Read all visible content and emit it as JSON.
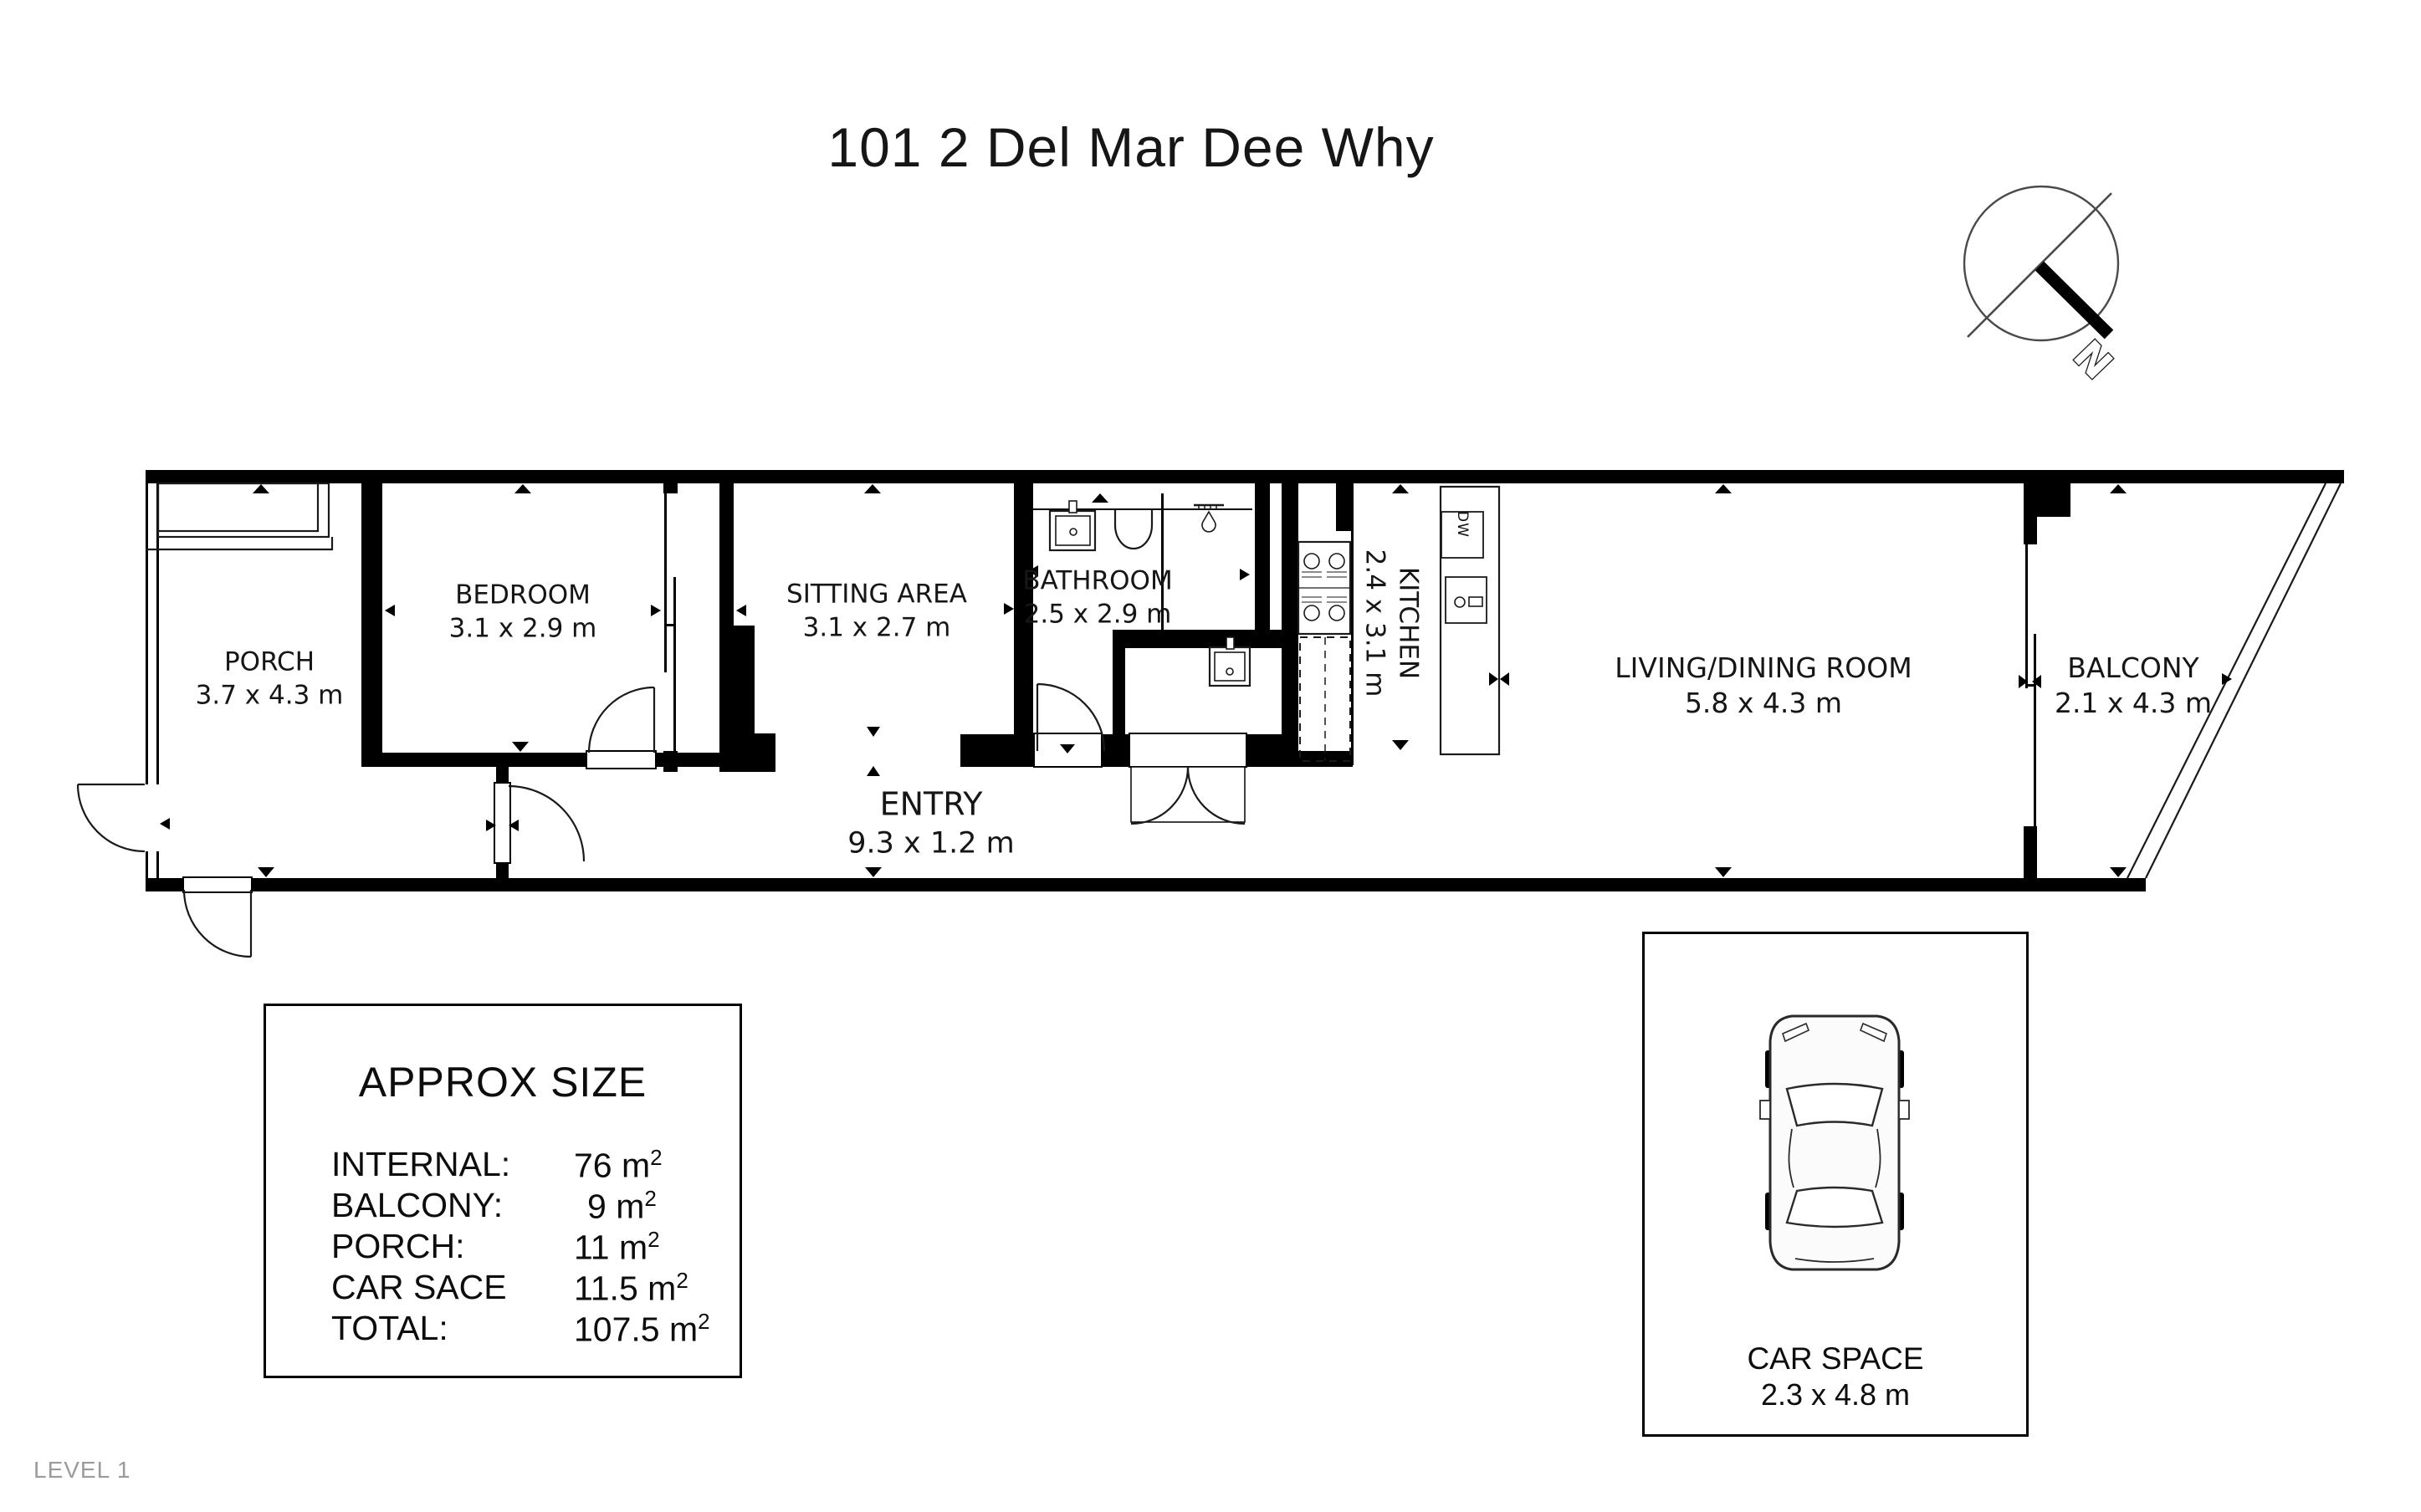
{
  "title": "101 2 Del Mar Dee Why",
  "level": "LEVEL 1",
  "compass": {
    "north_label": "N"
  },
  "plan": {
    "rooms": [
      {
        "key": "porch",
        "name": "PORCH",
        "dims": "3.7 x 4.3 m"
      },
      {
        "key": "bedroom",
        "name": "BEDROOM",
        "dims": "3.1 x 2.9 m"
      },
      {
        "key": "sitting-area",
        "name": "SITTING AREA",
        "dims": "3.1 x 2.7 m"
      },
      {
        "key": "bathroom",
        "name": "BATHROOM",
        "dims": "2.5 x 2.9 m"
      },
      {
        "key": "entry",
        "name": "ENTRY",
        "dims": "9.3 x 1.2 m"
      },
      {
        "key": "kitchen",
        "name": "KITCHEN",
        "dims": "2.4 x 3.1 m"
      },
      {
        "key": "living-dining",
        "name": "LIVING/DINING ROOM",
        "dims": "5.8 x 4.3 m"
      },
      {
        "key": "balcony",
        "name": "BALCONY",
        "dims": "2.1 x 4.3 m"
      }
    ],
    "appliances": {
      "dishwasher_label": "DW"
    }
  },
  "size_summary": {
    "title": "APPROX SIZE",
    "rows": [
      {
        "label": "INTERNAL:",
        "value": "76 m",
        "sup": "2"
      },
      {
        "label": "BALCONY:",
        "value": "9 m",
        "sup": "2"
      },
      {
        "label": "PORCH:",
        "value": "11 m",
        "sup": "2"
      },
      {
        "label": "CAR SACE",
        "value": "11.5 m",
        "sup": "2"
      },
      {
        "label": "TOTAL:",
        "value": "107.5 m",
        "sup": "2"
      }
    ]
  },
  "car_space": {
    "name": "CAR SPACE",
    "dims": "2.3 x 4.8 m"
  },
  "colors": {
    "wall": "#000000",
    "line": "#1a1a1a",
    "muted": "#9b9b9b"
  }
}
